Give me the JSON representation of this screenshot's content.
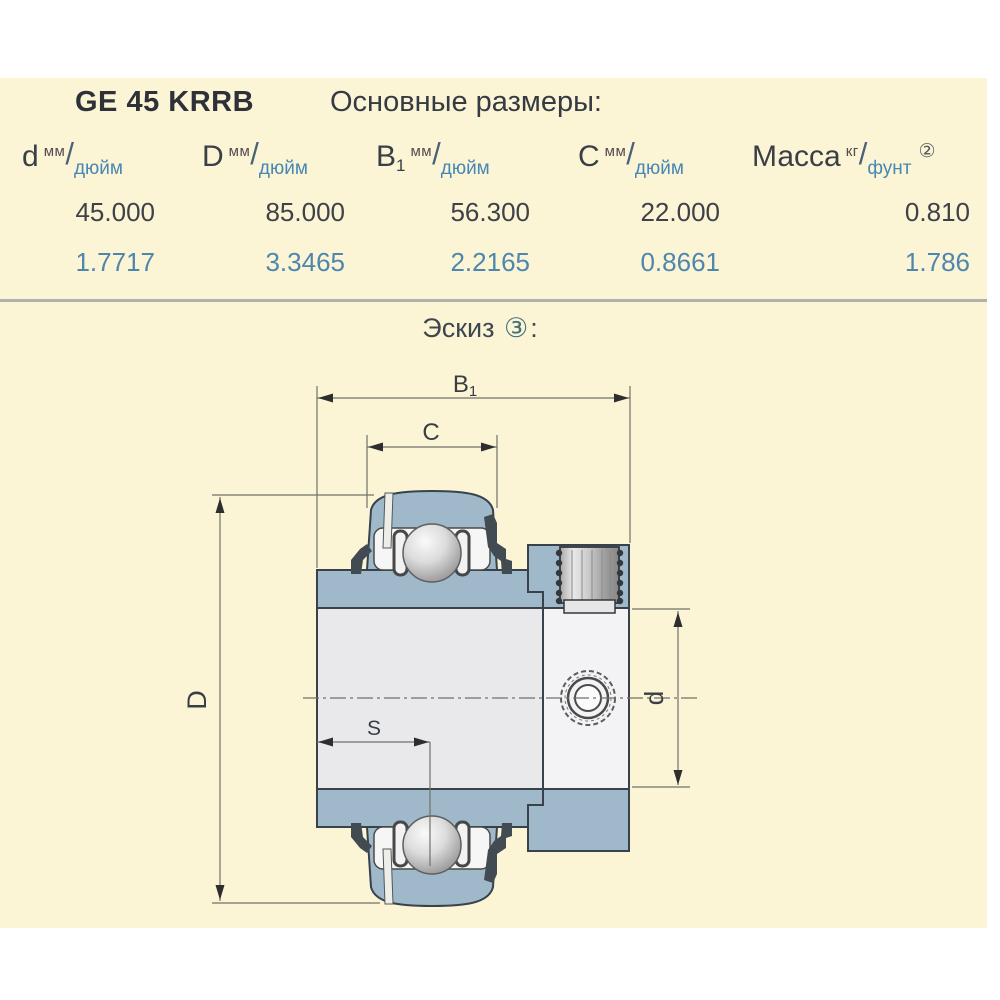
{
  "page": {
    "background": "#FFFFFF",
    "panel_color": "#FBF5D6"
  },
  "header": {
    "model": "GE 45 KRRB",
    "section_title": "Основные размеры:"
  },
  "table": {
    "unit_slash": "/",
    "columns": [
      {
        "symbol": "d",
        "sub": "",
        "unit_top": "мм",
        "unit_bottom": "дюйм",
        "note": ""
      },
      {
        "symbol": "D",
        "sub": "",
        "unit_top": "мм",
        "unit_bottom": "дюйм",
        "note": ""
      },
      {
        "symbol": "B",
        "sub": "1",
        "unit_top": "мм",
        "unit_bottom": "дюйм",
        "note": ""
      },
      {
        "symbol": "C",
        "sub": "",
        "unit_top": "мм",
        "unit_bottom": "дюйм",
        "note": ""
      },
      {
        "symbol": "Масса",
        "sub": "",
        "unit_top": "кг",
        "unit_bottom": "фунт",
        "note": "②"
      }
    ],
    "rows": [
      {
        "name": "mm",
        "values": [
          "45.000",
          "85.000",
          "56.300",
          "22.000",
          "0.810"
        ]
      },
      {
        "name": "inch",
        "values": [
          "1.7717",
          "3.3465",
          "2.2165",
          "0.8661",
          "1.786"
        ]
      }
    ]
  },
  "sketch": {
    "title": "Эскиз",
    "title_note": "③",
    "title_colon": ":",
    "labels": {
      "b": "B",
      "b_sub": "1",
      "c": "C",
      "outer_diameter": "D",
      "bore_diameter": "d",
      "s": "S"
    }
  }
}
